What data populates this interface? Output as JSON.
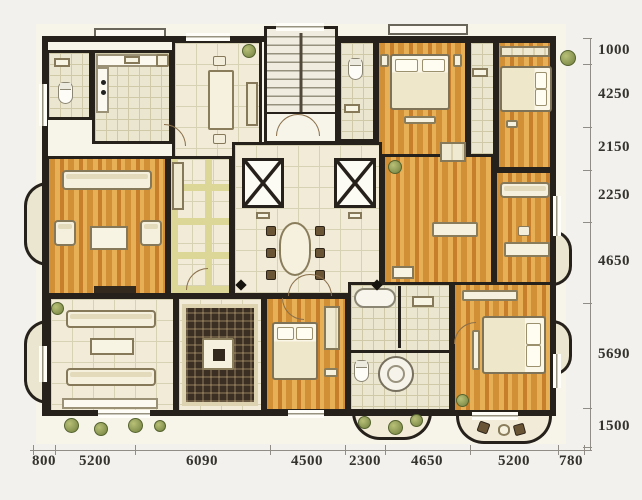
{
  "colors": {
    "bg": "#f2f1ed",
    "paper": "#f7f4ea",
    "wall": "#26211b",
    "wood1": "#d18f36",
    "wood2": "#e7b057",
    "wood3": "#c87f2c",
    "tile": "#f1ebd8",
    "tileLine": "#d8d2b4",
    "accent": "#dcd697",
    "bath": "#eae6cf",
    "bathLine": "#cfc9a8",
    "rug": "#3b2e23",
    "rugBorder": "#ddd3b0",
    "furn": "#f6f1de",
    "furnBorder": "#8a7d5c",
    "plant1": "#b9c077",
    "plant2": "#6f7f3e",
    "dimText": "#35332d",
    "dimLine": "#8f8d86"
  },
  "dimensions": {
    "right": {
      "values": [
        "1000",
        "4250",
        "2150",
        "2250",
        "4650",
        "5690",
        "1500"
      ]
    },
    "bottom": {
      "values": [
        "800",
        "5200",
        "6090",
        "4500",
        "2300",
        "4650",
        "5200",
        "780"
      ]
    }
  }
}
